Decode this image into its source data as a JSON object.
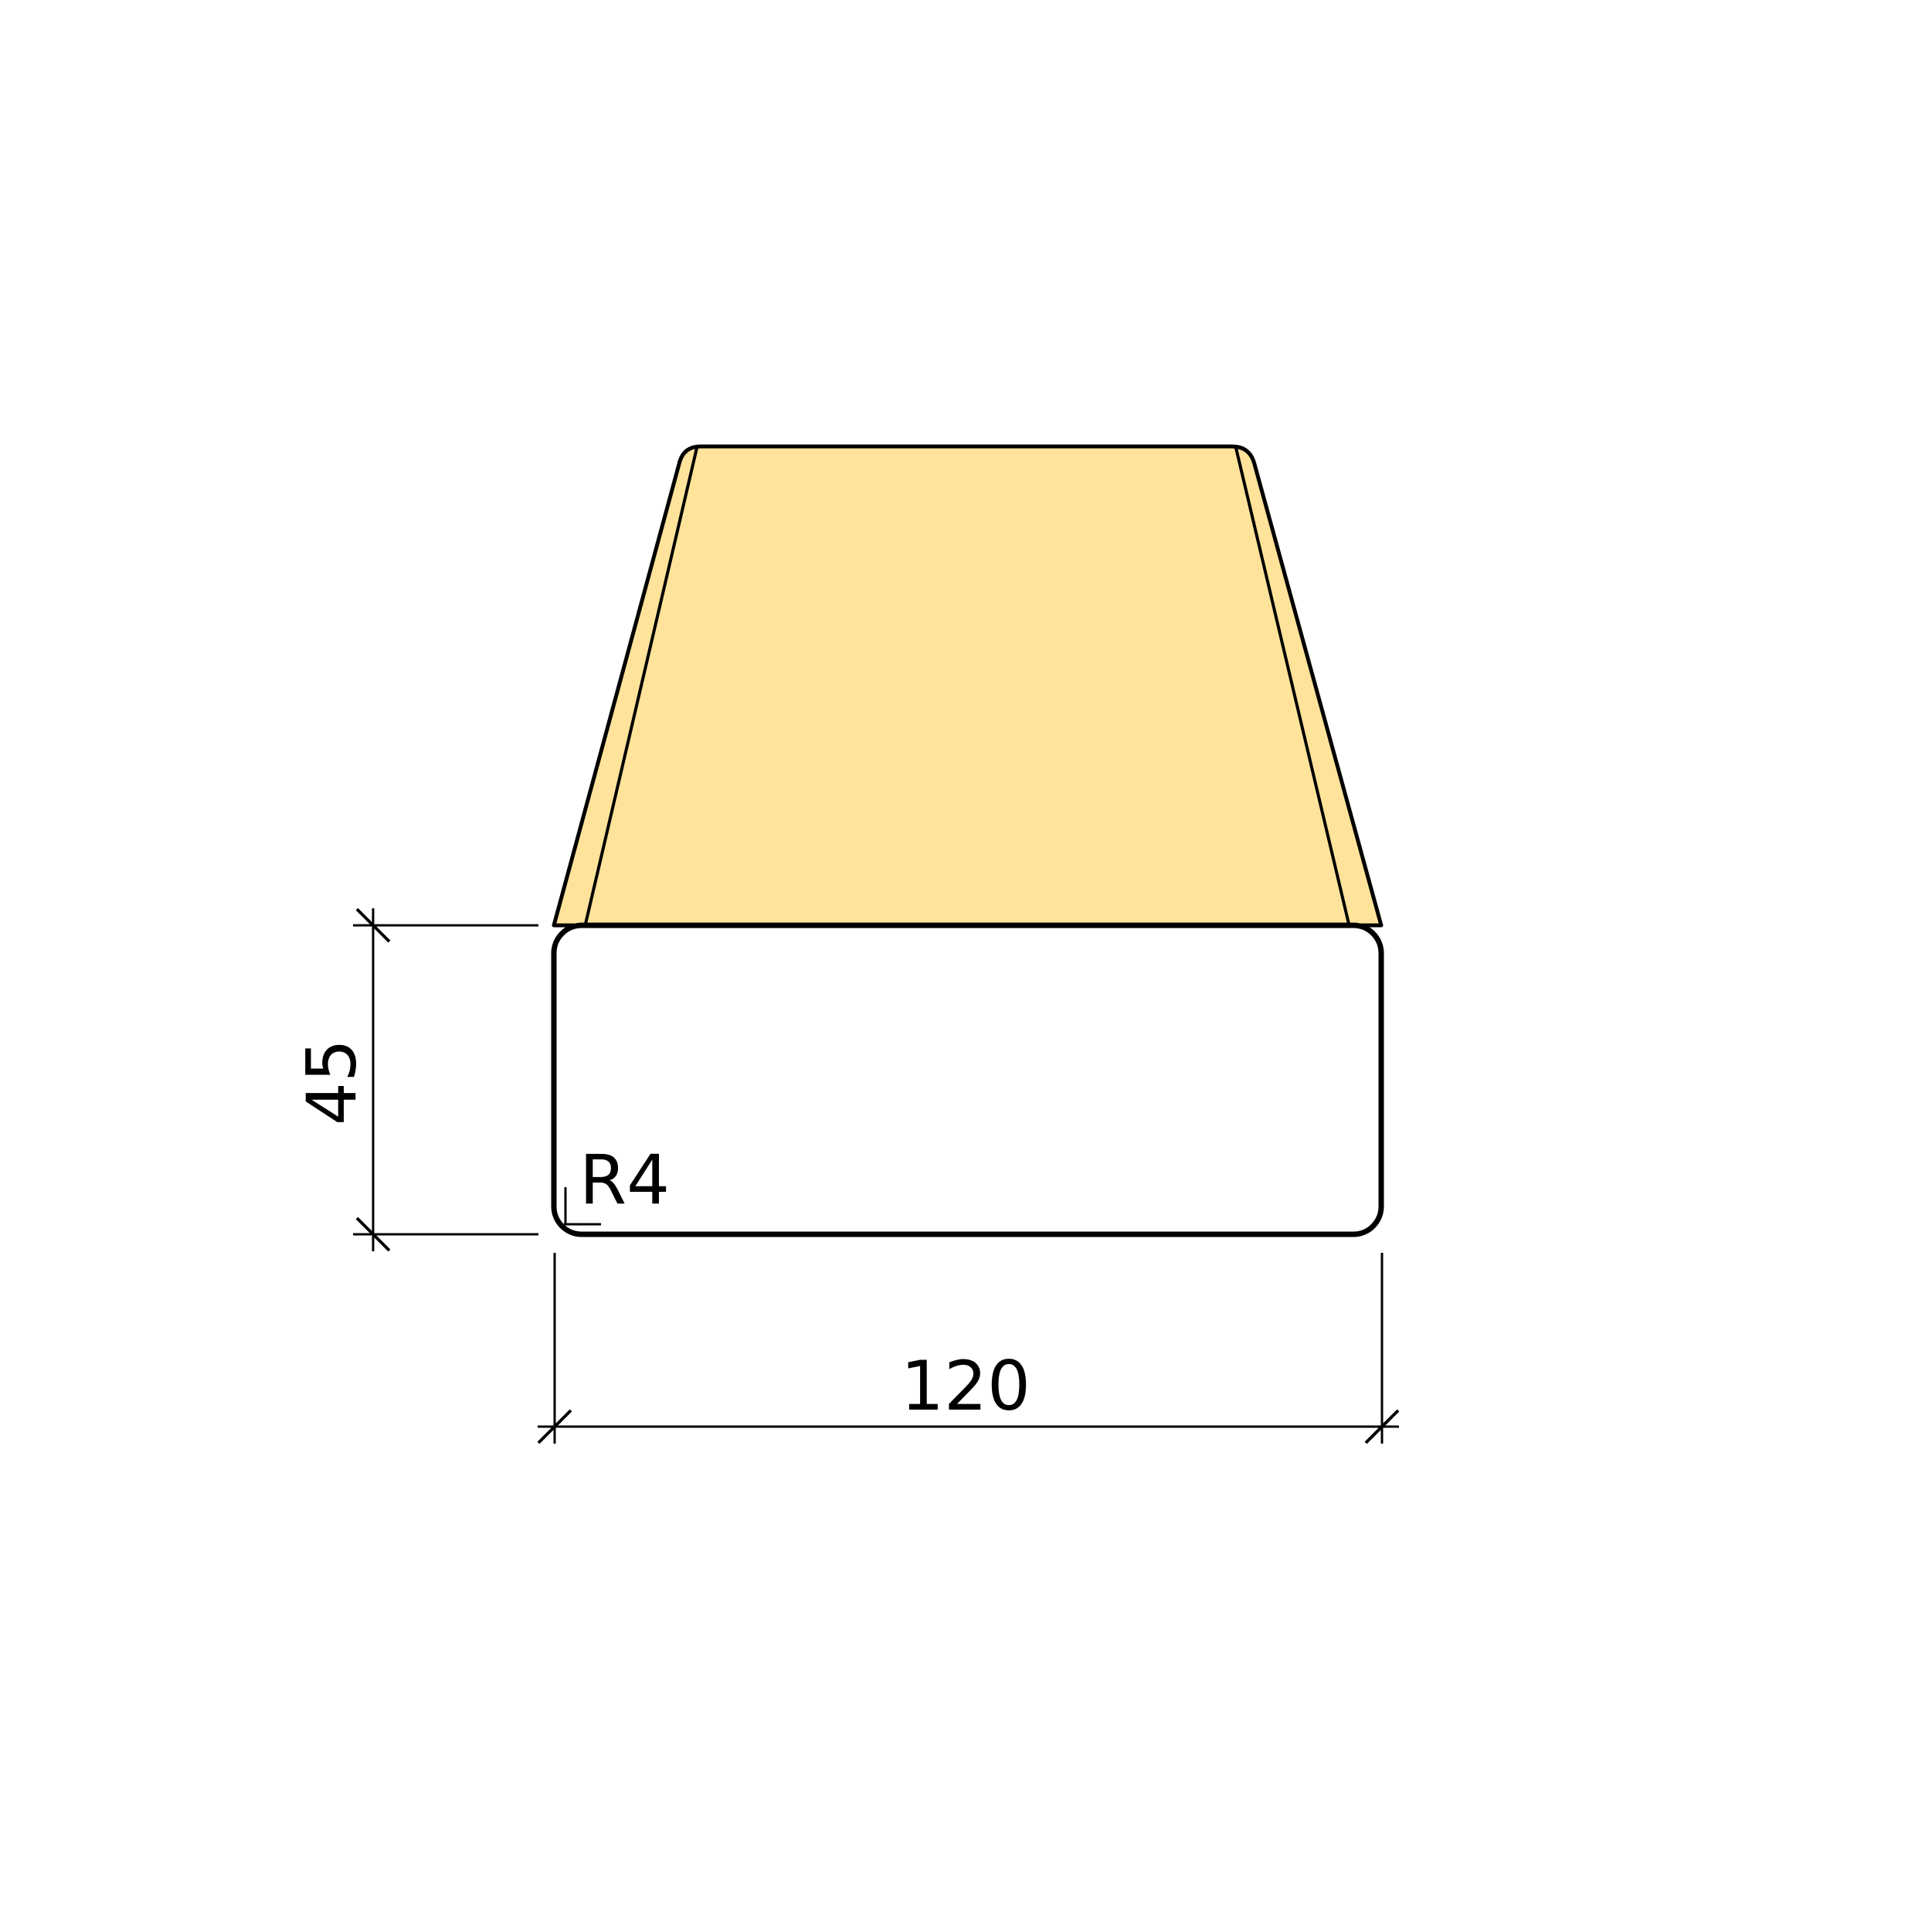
{
  "drawing": {
    "labels": {
      "height": "45",
      "width": "120",
      "corner_radius": "R4"
    },
    "colors": {
      "top_face": "#FFE39B",
      "front_face": "#FBCE79",
      "outline": "#000000",
      "background": "#FFFFFF"
    }
  }
}
